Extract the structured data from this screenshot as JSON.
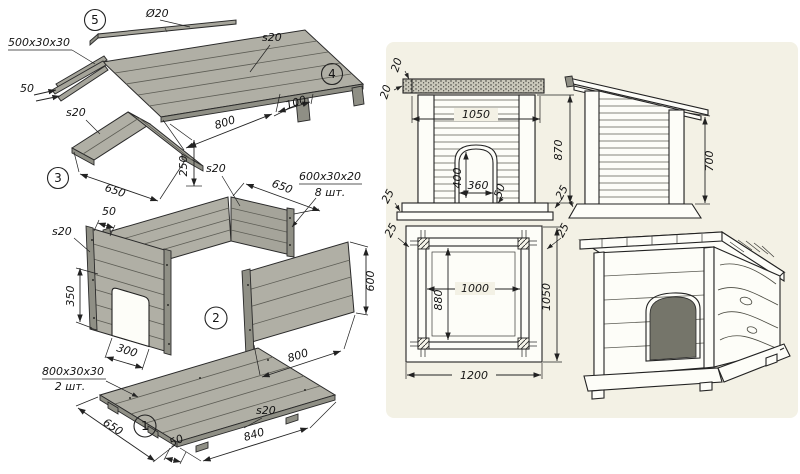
{
  "exploded_view": {
    "badges": {
      "b1": "1",
      "b2": "2",
      "b3": "3",
      "b4": "4",
      "b5": "5"
    },
    "labels": {
      "rod_diameter": "Ø20",
      "ridge_bar_size": "500x30x30",
      "ridge_offset": "50",
      "gable_thickness": "s20",
      "roof_thickness": "s20",
      "roof_length": "800",
      "roof_overhang": "100",
      "gable_height": "250",
      "gable_width": "650",
      "back_wall_thickness": "s20",
      "back_wall_width": "650",
      "batten_size": "600x30x20",
      "batten_qty": "8 шт.",
      "front_wall_thickness": "s20",
      "post_offset": "50",
      "door_height": "350",
      "door_width": "300",
      "side_wall_height": "600",
      "side_wall_length": "800",
      "skid_size": "800x30x30",
      "skid_qty": "2 шт.",
      "floor_width": "650",
      "floor_edge_offset": "50",
      "floor_thickness": "s20",
      "floor_length": "840"
    }
  },
  "front_view": {
    "roof_overhang": "20",
    "roof_thickness": "20",
    "width": "1050",
    "door_height": "400",
    "door_width": "360",
    "door_margin": "50",
    "wall_height": "870",
    "base_height_left": "25",
    "base_height_right": "25"
  },
  "side_view": {
    "wall_height": "700"
  },
  "plan_view": {
    "corner_left": "25",
    "corner_right": "25",
    "inner_width": "1000",
    "inner_depth": "880",
    "outer_depth": "1050",
    "outer_width": "1200"
  }
}
